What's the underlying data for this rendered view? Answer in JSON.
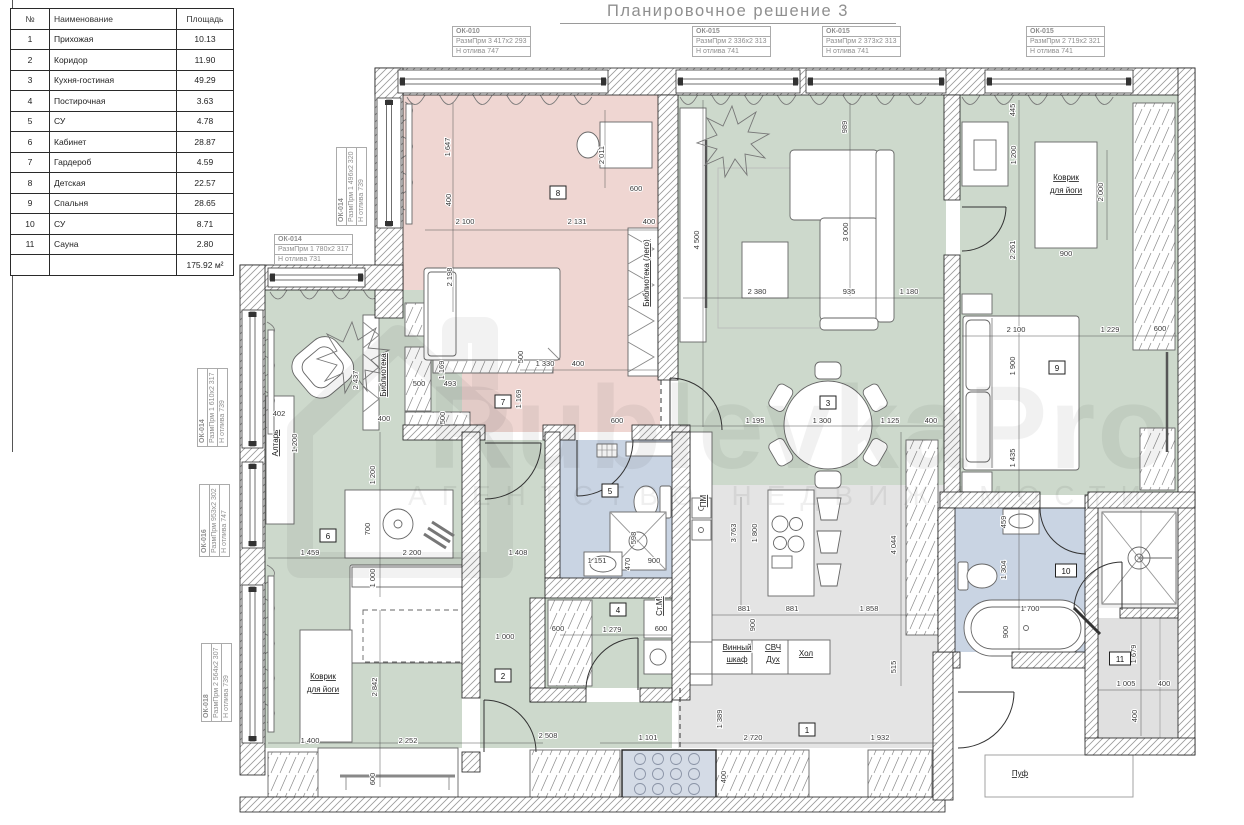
{
  "meta": {
    "title": "Планировочное решение 3"
  },
  "watermark": {
    "big": "RublevkaPro",
    "sub": "АГЕНТСТВО НЕДВИЖИМОСТИ"
  },
  "table": {
    "headers": [
      "№",
      "Наименование",
      "Площадь"
    ],
    "rows": [
      [
        "1",
        "Прихожая",
        "10.13"
      ],
      [
        "2",
        "Коридор",
        "11.90"
      ],
      [
        "3",
        "Кухня-гостиная",
        "49.29"
      ],
      [
        "4",
        "Постирочная",
        "3.63"
      ],
      [
        "5",
        "СУ",
        "4.78"
      ],
      [
        "6",
        "Кабинет",
        "28.87"
      ],
      [
        "7",
        "Гардероб",
        "4.59"
      ],
      [
        "8",
        "Детская",
        "22.57"
      ],
      [
        "9",
        "Спальня",
        "28.65"
      ],
      [
        "10",
        "СУ",
        "8.71"
      ],
      [
        "11",
        "Сауна",
        "2.80"
      ]
    ],
    "total": "175.92 м²"
  },
  "callouts": [
    {
      "id": "ОК-010",
      "l1": "РазмПрм",
      "v1": "3 417х2 293",
      "l2": "Н отлива",
      "v2": "747",
      "x": 452,
      "y": 26,
      "vert": false
    },
    {
      "id": "ОК-015",
      "l1": "РазмПрм",
      "v1": "2 336х2 313",
      "l2": "Н отлива",
      "v2": "741",
      "x": 692,
      "y": 26,
      "vert": false
    },
    {
      "id": "ОК-015",
      "l1": "РазмПрм",
      "v1": "2 373х2 313",
      "l2": "Н отлива",
      "v2": "741",
      "x": 822,
      "y": 26,
      "vert": false
    },
    {
      "id": "ОК-015",
      "l1": "РазмПрм",
      "v1": "2 719х2 321",
      "l2": "Н отлива",
      "v2": "741",
      "x": 1026,
      "y": 26,
      "vert": false
    },
    {
      "id": "ОК-014",
      "l1": "РазмПрм",
      "v1": "1 496х2 320",
      "l2": "Н отлива",
      "v2": "739",
      "x": 336,
      "y": 226,
      "vert": true
    },
    {
      "id": "ОК-014",
      "l1": "РазмПрм",
      "v1": "1 780х2 317",
      "l2": "Н отлива",
      "v2": "731",
      "x": 274,
      "y": 234,
      "vert": false
    },
    {
      "id": "ОК-014",
      "l1": "РазмПрм",
      "v1": "1 610х2 317",
      "l2": "Н отлива",
      "v2": "739",
      "x": 197,
      "y": 447,
      "vert": true
    },
    {
      "id": "ОК-016",
      "l1": "РазмПрм",
      "v1": "953х2 302",
      "l2": "Н отлива",
      "v2": "747",
      "x": 199,
      "y": 557,
      "vert": true
    },
    {
      "id": "ОК-018",
      "l1": "РазмПрм",
      "v1": "2 564х2 307",
      "l2": "Н отлива",
      "v2": "739",
      "x": 201,
      "y": 722,
      "vert": true
    }
  ],
  "plan": {
    "colors": {
      "pink": "#efd6d2",
      "green": "#cdd9cc",
      "blue": "#c9d4e3",
      "gray": "#e4e4e4",
      "sauna": "#e0e0e0",
      "shower": "#eeeeee"
    },
    "rooms": [
      {
        "x": 403,
        "y": 95,
        "w": 257,
        "h": 337,
        "f": "#efd6d2"
      },
      {
        "x": 678,
        "y": 95,
        "w": 268,
        "h": 390,
        "f": "#cdd9cc"
      },
      {
        "x": 960,
        "y": 95,
        "w": 218,
        "h": 400,
        "f": "#cdd9cc"
      },
      {
        "x": 265,
        "y": 290,
        "w": 197,
        "h": 458,
        "f": "#cdd9cc"
      },
      {
        "x": 480,
        "y": 440,
        "w": 65,
        "h": 308,
        "f": "#cdd9cc"
      },
      {
        "x": 545,
        "y": 702,
        "w": 127,
        "h": 46,
        "f": "#cdd9cc"
      },
      {
        "x": 545,
        "y": 598,
        "w": 127,
        "h": 90,
        "f": "#cdd9cc"
      },
      {
        "x": 560,
        "y": 440,
        "w": 112,
        "h": 138,
        "f": "#c9d4e3"
      },
      {
        "x": 955,
        "y": 508,
        "w": 130,
        "h": 144,
        "f": "#c9d4e3"
      },
      {
        "x": 678,
        "y": 485,
        "w": 266,
        "h": 263,
        "f": "#e4e4e4"
      },
      {
        "x": 1098,
        "y": 508,
        "w": 80,
        "h": 100,
        "f": "#eeeeee"
      },
      {
        "x": 1098,
        "y": 618,
        "w": 80,
        "h": 120,
        "f": "#e0e0e0"
      }
    ],
    "walls": [
      {
        "x": 375,
        "y": 68,
        "w": 820,
        "h": 27
      },
      {
        "x": 375,
        "y": 68,
        "w": 28,
        "h": 250
      },
      {
        "x": 240,
        "y": 265,
        "w": 163,
        "h": 25
      },
      {
        "x": 240,
        "y": 265,
        "w": 25,
        "h": 510
      },
      {
        "x": 240,
        "y": 797,
        "w": 705,
        "h": 15
      },
      {
        "x": 1178,
        "y": 68,
        "w": 17,
        "h": 687
      },
      {
        "x": 933,
        "y": 652,
        "w": 20,
        "h": 148
      },
      {
        "x": 953,
        "y": 652,
        "w": 7,
        "h": 16
      },
      {
        "x": 1012,
        "y": 652,
        "w": 86,
        "h": 16
      },
      {
        "x": 1085,
        "y": 495,
        "w": 13,
        "h": 245
      },
      {
        "x": 1085,
        "y": 738,
        "w": 110,
        "h": 17
      },
      {
        "x": 944,
        "y": 95,
        "w": 16,
        "h": 105
      },
      {
        "x": 944,
        "y": 255,
        "w": 16,
        "h": 250
      },
      {
        "x": 658,
        "y": 95,
        "w": 20,
        "h": 285
      },
      {
        "x": 403,
        "y": 425,
        "w": 82,
        "h": 15
      },
      {
        "x": 543,
        "y": 425,
        "w": 32,
        "h": 15
      },
      {
        "x": 632,
        "y": 425,
        "w": 58,
        "h": 15
      },
      {
        "x": 672,
        "y": 432,
        "w": 18,
        "h": 268
      },
      {
        "x": 462,
        "y": 432,
        "w": 18,
        "h": 266
      },
      {
        "x": 462,
        "y": 752,
        "w": 18,
        "h": 20
      },
      {
        "x": 545,
        "y": 432,
        "w": 15,
        "h": 146
      },
      {
        "x": 545,
        "y": 578,
        "w": 127,
        "h": 20
      },
      {
        "x": 530,
        "y": 598,
        "w": 15,
        "h": 104
      },
      {
        "x": 530,
        "y": 688,
        "w": 56,
        "h": 14
      },
      {
        "x": 640,
        "y": 688,
        "w": 32,
        "h": 14
      },
      {
        "x": 940,
        "y": 492,
        "w": 100,
        "h": 16
      },
      {
        "x": 1088,
        "y": 492,
        "w": 107,
        "h": 16
      },
      {
        "x": 938,
        "y": 508,
        "w": 17,
        "h": 144
      },
      {
        "x": 1120,
        "y": 608,
        "w": 58,
        "h": 10
      }
    ],
    "windows": [
      {
        "x": 398,
        "y": 70,
        "w": 210,
        "h": 23,
        "o": "h"
      },
      {
        "x": 676,
        "y": 70,
        "w": 124,
        "h": 23,
        "o": "h"
      },
      {
        "x": 806,
        "y": 70,
        "w": 140,
        "h": 23,
        "o": "h"
      },
      {
        "x": 985,
        "y": 70,
        "w": 148,
        "h": 23,
        "o": "h"
      },
      {
        "x": 377,
        "y": 98,
        "w": 24,
        "h": 130,
        "o": "v"
      },
      {
        "x": 268,
        "y": 268,
        "w": 97,
        "h": 19,
        "o": "h"
      },
      {
        "x": 242,
        "y": 310,
        "w": 21,
        "h": 138,
        "o": "v"
      },
      {
        "x": 242,
        "y": 462,
        "w": 21,
        "h": 86,
        "o": "v"
      },
      {
        "x": 242,
        "y": 585,
        "w": 21,
        "h": 158,
        "o": "v"
      }
    ],
    "badges": [
      {
        "n": "1",
        "x": 807,
        "y": 730
      },
      {
        "n": "2",
        "x": 503,
        "y": 676
      },
      {
        "n": "3",
        "x": 828,
        "y": 403
      },
      {
        "n": "4",
        "x": 618,
        "y": 610
      },
      {
        "n": "5",
        "x": 610,
        "y": 491
      },
      {
        "n": "6",
        "x": 328,
        "y": 536
      },
      {
        "n": "7",
        "x": 503,
        "y": 402
      },
      {
        "n": "8",
        "x": 558,
        "y": 193
      },
      {
        "n": "9",
        "x": 1057,
        "y": 368
      },
      {
        "n": "10",
        "x": 1066,
        "y": 571
      },
      {
        "n": "11",
        "x": 1120,
        "y": 659
      }
    ],
    "dims": [
      {
        "t": "1 647",
        "x": 450,
        "y": 147,
        "v": 1
      },
      {
        "t": "400",
        "x": 451,
        "y": 200,
        "v": 1
      },
      {
        "t": "2 100",
        "x": 465,
        "y": 224
      },
      {
        "t": "2 131",
        "x": 577,
        "y": 224
      },
      {
        "t": "400",
        "x": 649,
        "y": 224
      },
      {
        "t": "2 011",
        "x": 604,
        "y": 155,
        "v": 1
      },
      {
        "t": "600",
        "x": 636,
        "y": 191
      },
      {
        "t": "2 198",
        "x": 452,
        "y": 277,
        "v": 1
      },
      {
        "t": "500",
        "x": 523,
        "y": 357,
        "v": 1
      },
      {
        "t": "1 330",
        "x": 545,
        "y": 366
      },
      {
        "t": "400",
        "x": 578,
        "y": 366
      },
      {
        "t": "1 169",
        "x": 444,
        "y": 370,
        "v": 1
      },
      {
        "t": "500",
        "x": 419,
        "y": 386
      },
      {
        "t": "493",
        "x": 450,
        "y": 386
      },
      {
        "t": "1 169",
        "x": 521,
        "y": 399,
        "v": 1
      },
      {
        "t": "500",
        "x": 445,
        "y": 418,
        "v": 1
      },
      {
        "t": "989",
        "x": 847,
        "y": 127,
        "v": 1
      },
      {
        "t": "4 500",
        "x": 699,
        "y": 240,
        "v": 1
      },
      {
        "t": "3 000",
        "x": 848,
        "y": 232,
        "v": 1
      },
      {
        "t": "2 380",
        "x": 757,
        "y": 294
      },
      {
        "t": "935",
        "x": 849,
        "y": 294
      },
      {
        "t": "1 180",
        "x": 909,
        "y": 294
      },
      {
        "t": "600",
        "x": 617,
        "y": 423
      },
      {
        "t": "1 195",
        "x": 755,
        "y": 423
      },
      {
        "t": "1 300",
        "x": 822,
        "y": 423
      },
      {
        "t": "1 125",
        "x": 890,
        "y": 423
      },
      {
        "t": "400",
        "x": 931,
        "y": 423
      },
      {
        "t": "445",
        "x": 1015,
        "y": 110,
        "v": 1
      },
      {
        "t": "1 200",
        "x": 1016,
        "y": 155,
        "v": 1
      },
      {
        "t": "2 000",
        "x": 1103,
        "y": 192,
        "v": 1
      },
      {
        "t": "900",
        "x": 1066,
        "y": 256
      },
      {
        "t": "2 261",
        "x": 1015,
        "y": 250,
        "v": 1
      },
      {
        "t": "2 100",
        "x": 1016,
        "y": 332
      },
      {
        "t": "1 229",
        "x": 1110,
        "y": 332
      },
      {
        "t": "600",
        "x": 1160,
        "y": 331
      },
      {
        "t": "1 900",
        "x": 1015,
        "y": 366,
        "v": 1
      },
      {
        "t": "1 435",
        "x": 1015,
        "y": 458,
        "v": 1
      },
      {
        "t": "402",
        "x": 279,
        "y": 416
      },
      {
        "t": "1 200",
        "x": 297,
        "y": 443,
        "v": 1
      },
      {
        "t": "2 437",
        "x": 358,
        "y": 380,
        "v": 1
      },
      {
        "t": "400",
        "x": 384,
        "y": 421
      },
      {
        "t": "1 200",
        "x": 375,
        "y": 475,
        "v": 1
      },
      {
        "t": "700",
        "x": 370,
        "y": 529,
        "v": 1
      },
      {
        "t": "1 459",
        "x": 310,
        "y": 555
      },
      {
        "t": "2 200",
        "x": 412,
        "y": 555
      },
      {
        "t": "1 408",
        "x": 518,
        "y": 555
      },
      {
        "t": "1 000",
        "x": 375,
        "y": 578,
        "v": 1
      },
      {
        "t": "2 842",
        "x": 377,
        "y": 687,
        "v": 1
      },
      {
        "t": "1 400",
        "x": 310,
        "y": 743
      },
      {
        "t": "2 252",
        "x": 408,
        "y": 743
      },
      {
        "t": "600",
        "x": 375,
        "y": 779,
        "v": 1
      },
      {
        "t": "1 000",
        "x": 505,
        "y": 639
      },
      {
        "t": "2 508",
        "x": 548,
        "y": 738
      },
      {
        "t": "598",
        "x": 636,
        "y": 538,
        "v": 1
      },
      {
        "t": "470",
        "x": 630,
        "y": 564,
        "v": 1
      },
      {
        "t": "1 151",
        "x": 597,
        "y": 563
      },
      {
        "t": "900",
        "x": 654,
        "y": 563
      },
      {
        "t": "600",
        "x": 558,
        "y": 631
      },
      {
        "t": "1 279",
        "x": 612,
        "y": 632
      },
      {
        "t": "600",
        "x": 661,
        "y": 631
      },
      {
        "t": "3 763",
        "x": 736,
        "y": 533,
        "v": 1
      },
      {
        "t": "1 800",
        "x": 757,
        "y": 533,
        "v": 1
      },
      {
        "t": "4 044",
        "x": 896,
        "y": 545,
        "v": 1
      },
      {
        "t": "881",
        "x": 744,
        "y": 611
      },
      {
        "t": "900",
        "x": 755,
        "y": 625,
        "v": 1
      },
      {
        "t": "881",
        "x": 792,
        "y": 611
      },
      {
        "t": "1 858",
        "x": 869,
        "y": 611
      },
      {
        "t": "515",
        "x": 896,
        "y": 667,
        "v": 1
      },
      {
        "t": "1 101",
        "x": 648,
        "y": 740
      },
      {
        "t": "1 389",
        "x": 722,
        "y": 719,
        "v": 1
      },
      {
        "t": "2 720",
        "x": 753,
        "y": 740
      },
      {
        "t": "1 932",
        "x": 880,
        "y": 740
      },
      {
        "t": "400",
        "x": 726,
        "y": 777,
        "v": 1
      },
      {
        "t": "459",
        "x": 1006,
        "y": 522,
        "v": 1
      },
      {
        "t": "1 304",
        "x": 1006,
        "y": 570,
        "v": 1
      },
      {
        "t": "1 700",
        "x": 1030,
        "y": 611
      },
      {
        "t": "900",
        "x": 1008,
        "y": 632,
        "v": 1
      },
      {
        "t": "1 679",
        "x": 1136,
        "y": 654,
        "v": 1
      },
      {
        "t": "1 005",
        "x": 1126,
        "y": 686
      },
      {
        "t": "400",
        "x": 1164,
        "y": 686
      },
      {
        "t": "400",
        "x": 1137,
        "y": 716,
        "v": 1
      }
    ],
    "labels": [
      {
        "t": "Библиотека (лего)",
        "x": 649,
        "y": 273,
        "v": 1
      },
      {
        "t": "Библиотека",
        "x": 386,
        "y": 375,
        "v": 1
      },
      {
        "t": "Алтарь",
        "x": 278,
        "y": 443,
        "v": 1
      },
      {
        "t": "Коврик",
        "x": 1066,
        "y": 180
      },
      {
        "t": "для йоги",
        "x": 1066,
        "y": 193
      },
      {
        "t": "Коврик",
        "x": 323,
        "y": 679
      },
      {
        "t": "для йоги",
        "x": 323,
        "y": 692
      },
      {
        "t": "ПМ",
        "x": 706,
        "y": 501,
        "v": 1
      },
      {
        "t": "Ст.М.",
        "x": 662,
        "y": 606,
        "v": 1
      },
      {
        "t": "Винный",
        "x": 737,
        "y": 650
      },
      {
        "t": "шкаф",
        "x": 737,
        "y": 662
      },
      {
        "t": "СВЧ",
        "x": 773,
        "y": 650
      },
      {
        "t": "Дух",
        "x": 773,
        "y": 662
      },
      {
        "t": "Хол",
        "x": 806,
        "y": 656
      },
      {
        "t": "Пуф",
        "x": 1020,
        "y": 776
      }
    ]
  }
}
